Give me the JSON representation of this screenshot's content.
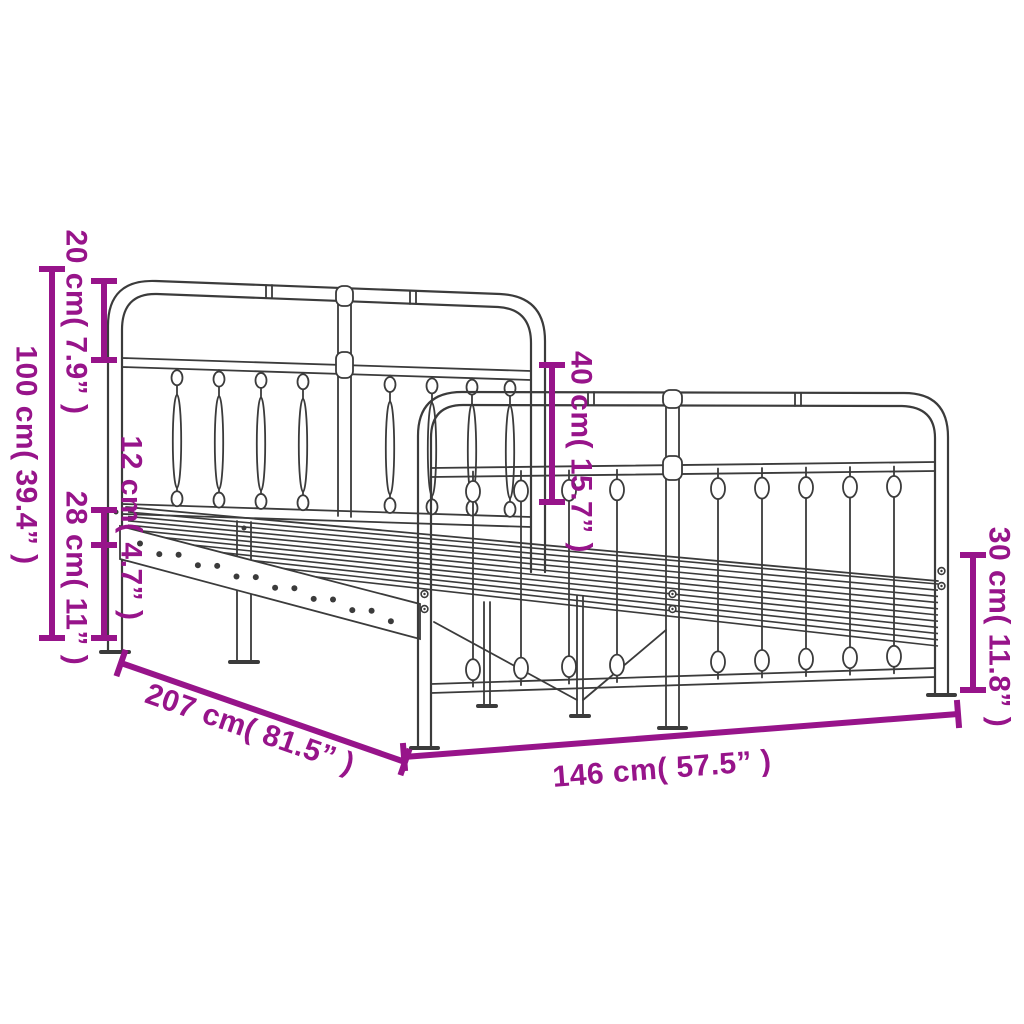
{
  "diagram": {
    "subject": "Metal bed frame with headboard and footboard — product dimension drawing",
    "background_color": "#FFFFFF",
    "drawing_color": "#3B3B3B",
    "accent_color": "#97148A",
    "unit_primary": "cm",
    "unit_secondary": "inches",
    "dimensions": [
      {
        "id": "headboard-top-section-height",
        "cm": "20",
        "inches": "7.9",
        "label": "20 cm( 7.9” )"
      },
      {
        "id": "headboard-total-height",
        "cm": "100",
        "inches": "39.4",
        "label": "100 cm( 39.4” )"
      },
      {
        "id": "side-rail-height",
        "cm": "12",
        "inches": "4.7",
        "label": "12 cm( 4.7” )"
      },
      {
        "id": "under-bed-clearance",
        "cm": "28",
        "inches": "11",
        "label": "28 cm( 11” )"
      },
      {
        "id": "footboard-height-above-base",
        "cm": "40",
        "inches": "15.7",
        "label": "40 cm( 15.7” )"
      },
      {
        "id": "footboard-lower-height",
        "cm": "30",
        "inches": "11.8",
        "label": "30 cm( 11.8” )"
      },
      {
        "id": "bed-length",
        "cm": "207",
        "inches": "81.5",
        "label": "207 cm( 81.5” )"
      },
      {
        "id": "bed-width",
        "cm": "146",
        "inches": "57.5",
        "label": "146 cm( 57.5” )"
      }
    ]
  }
}
